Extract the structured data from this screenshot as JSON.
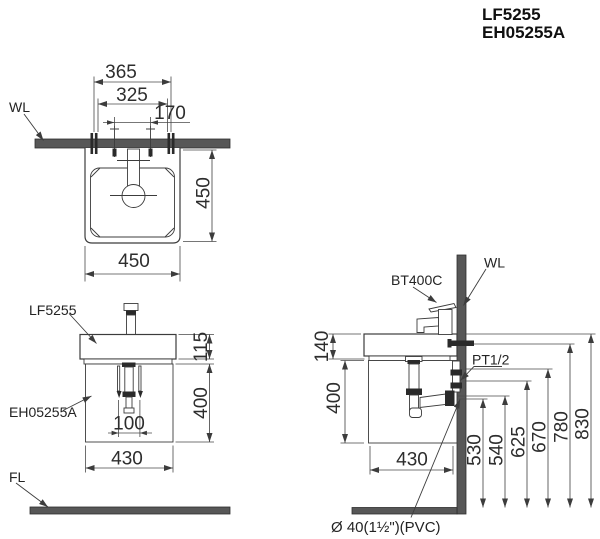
{
  "title": {
    "model_basin": "LF5255",
    "model_cabinet": "EH05255A"
  },
  "top_view": {
    "wall_label": "WL",
    "dim_overall_width": "365",
    "dim_bolt_spacing": "325",
    "dim_hole_spacing": "170",
    "dim_depth": "450",
    "dim_width": "450"
  },
  "front_view": {
    "basin_label": "LF5255",
    "cabinet_label": "EH05255A",
    "floor_label": "FL",
    "dim_basin_height": "115",
    "dim_cabinet_height": "400",
    "dim_drain_spacing": "100",
    "dim_cabinet_width": "430"
  },
  "side_view": {
    "faucet_label": "BT400C",
    "wall_label": "WL",
    "supply_label": "PT1/2",
    "drain_label": "Ø 40(1½\")(PVC)",
    "dim_basin_height": "140",
    "dim_cabinet_height": "400",
    "dim_cabinet_depth": "430",
    "heights": [
      "530",
      "540",
      "625",
      "670",
      "780",
      "830"
    ]
  },
  "colors": {
    "line": "#3c3c3c",
    "text": "#2d2d2d",
    "wall_fill": "#575757",
    "background": "#ffffff"
  }
}
